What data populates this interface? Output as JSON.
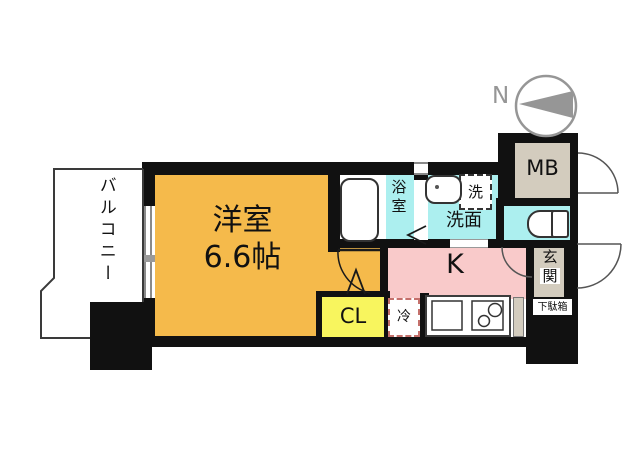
{
  "title": "1K apartment floor plan",
  "compass": {
    "label": "N"
  },
  "rooms": {
    "balcony": {
      "label": "バルコニー"
    },
    "main_room": {
      "label": "洋室",
      "size": "6.6帖"
    },
    "bathroom": {
      "label": "浴室"
    },
    "washroom": {
      "label": "洗面"
    },
    "washer": {
      "label": "洗"
    },
    "kitchen": {
      "label": "K"
    },
    "closet": {
      "label": "CL"
    },
    "fridge": {
      "label": "冷"
    },
    "meter_box": {
      "label": "MB"
    },
    "entrance": {
      "label_top": "玄",
      "label_bottom": "関"
    },
    "shoe_box": {
      "label": "下駄箱"
    }
  },
  "colors": {
    "wall": "#111111",
    "orange": "#F5BA4B",
    "teal": "#ACEFEF",
    "pink": "#F9CACA",
    "yellow": "#F8F55E",
    "beige": "#D3CCBE",
    "outline": "#3a3a3a",
    "doorline": "#555555",
    "compass": "#969696",
    "fridge-dash": "#C4706B"
  }
}
